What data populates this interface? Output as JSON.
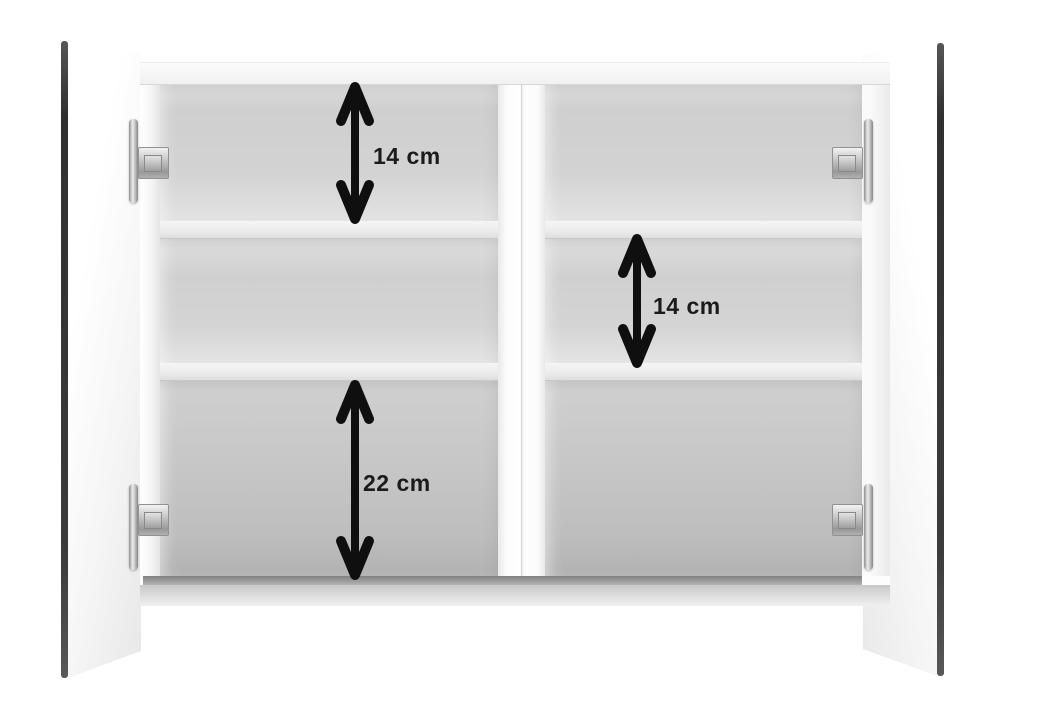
{
  "image": {
    "subject": "Two-door mirrored bathroom wall cabinet shown open, revealing two columns of compartments separated by shelves",
    "background_color": "#ffffff",
    "annotation_color": "#0f0f0f",
    "annotations": [
      {
        "id": "upper-compartment-height",
        "label": "14 cm"
      },
      {
        "id": "middle-compartment-height",
        "label": "14 cm"
      },
      {
        "id": "lower-compartment-height",
        "label": "22 cm"
      }
    ]
  }
}
